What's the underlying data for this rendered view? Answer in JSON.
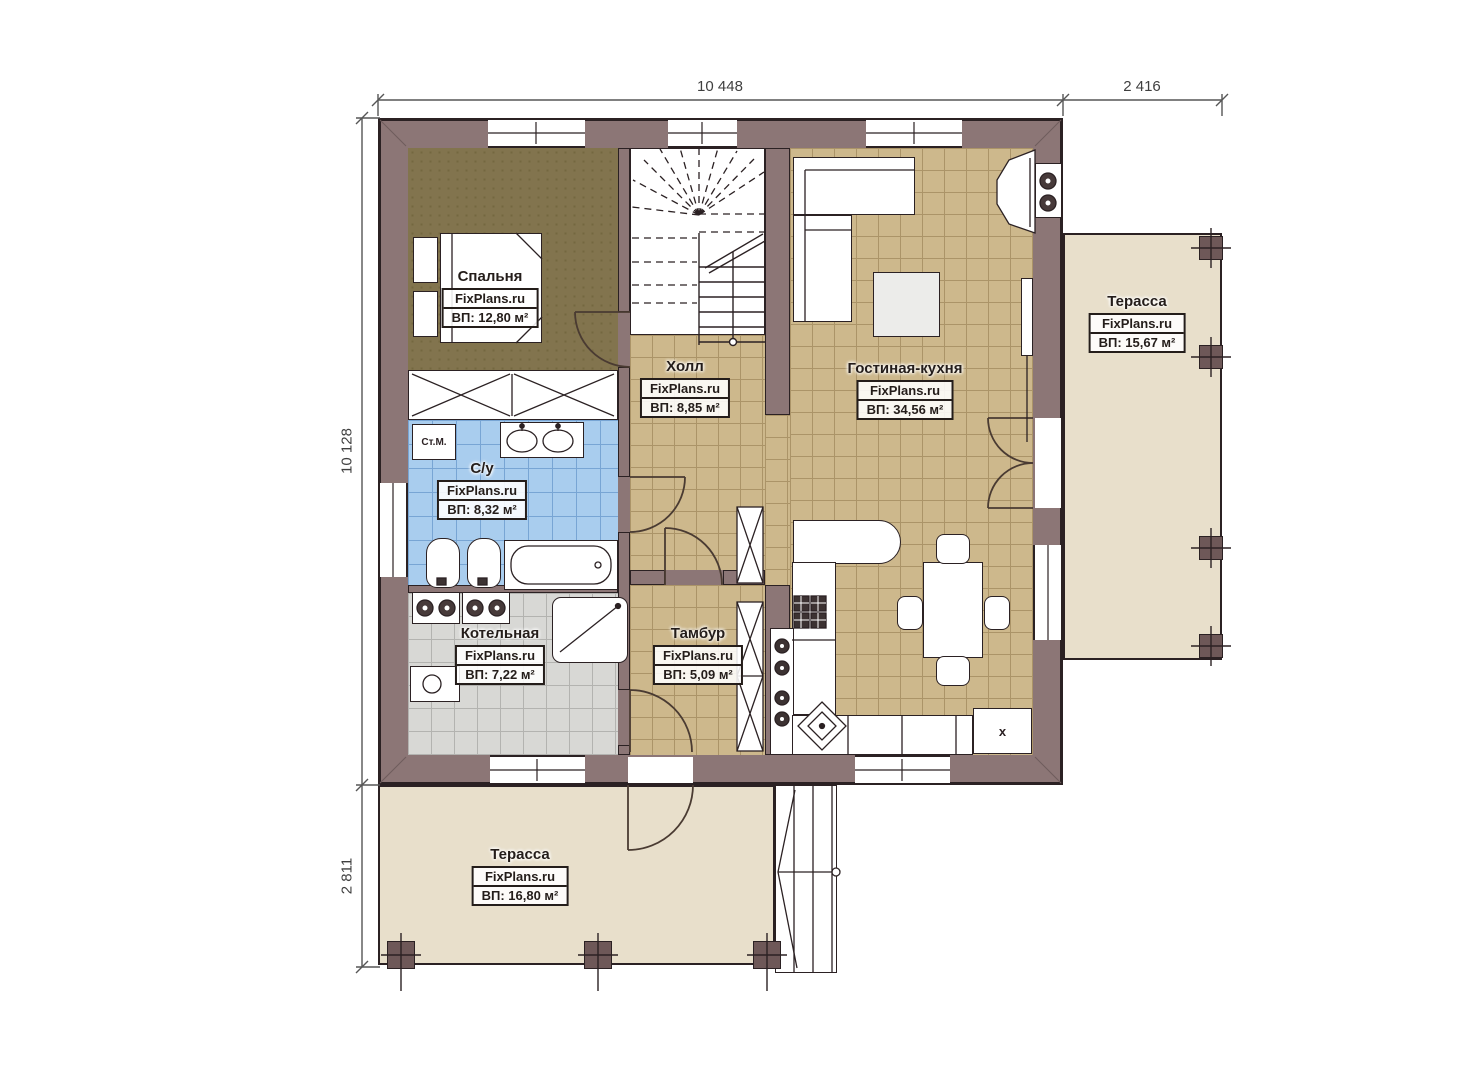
{
  "dims": {
    "top": "10 448",
    "top_right": "2 416",
    "left": "10 128",
    "bottom_left": "2 811"
  },
  "rooms": [
    {
      "id": "bedroom",
      "name": "Спальня",
      "brand": "FixPlans.ru",
      "area": "ВП: 12,80 м²"
    },
    {
      "id": "hall",
      "name": "Холл",
      "brand": "FixPlans.ru",
      "area": "ВП: 8,85 м²"
    },
    {
      "id": "living-kitchen",
      "name": "Гостиная-кухня",
      "brand": "FixPlans.ru",
      "area": "ВП: 34,56 м²"
    },
    {
      "id": "bathroom",
      "name": "С/у",
      "brand": "FixPlans.ru",
      "area": "ВП: 8,32 м²"
    },
    {
      "id": "boiler",
      "name": "Котельная",
      "brand": "FixPlans.ru",
      "area": "ВП: 7,22 м²"
    },
    {
      "id": "vestibule",
      "name": "Тамбур",
      "brand": "FixPlans.ru",
      "area": "ВП: 5,09 м²"
    },
    {
      "id": "terrace-right",
      "name": "Терасса",
      "brand": "FixPlans.ru",
      "area": "ВП: 15,67 м²"
    },
    {
      "id": "terrace-bottom",
      "name": "Терасса",
      "brand": "FixPlans.ru",
      "area": "ВП: 16,80 м²"
    }
  ],
  "labels": {
    "washing_machine": "Ст.М.",
    "appliance_x": "x"
  },
  "colors": {
    "wall": "#8c7676",
    "outline": "#2b2123",
    "floor_tan": "#cdb88c",
    "floor_blue": "#a9cdee",
    "floor_gray": "#d8d8d5",
    "floor_bedroom": "#82744e",
    "terrace": "#e8dfcb"
  }
}
